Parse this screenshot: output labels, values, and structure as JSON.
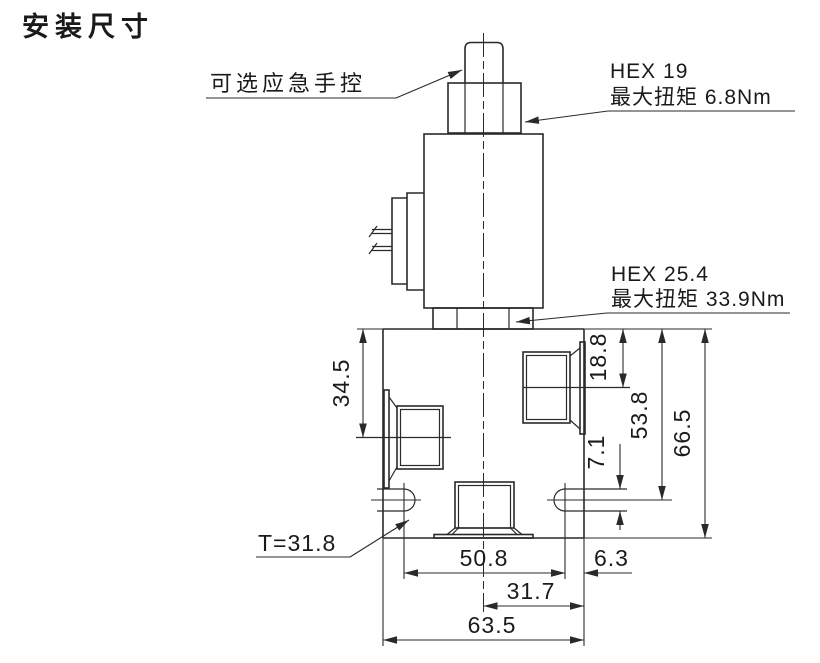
{
  "title": "安装尺寸",
  "labels": {
    "manual_override": "可选应急手控",
    "hex_top": {
      "line1": "HEX 19",
      "line2": "最大扭矩 6.8Nm"
    },
    "hex_cartridge": {
      "line1": "HEX 25.4",
      "line2": "最大扭矩 33.9Nm"
    },
    "thread_depth": "T=31.8"
  },
  "dims": {
    "left_port_from_top": "34.5",
    "right_port_from_top": "18.8",
    "slot_center_from_top": "53.8",
    "body_height": "66.5",
    "slot_width": "7.1",
    "slot_spacing": "50.8",
    "slot_to_edge": "6.3",
    "center_to_edge": "31.7",
    "body_width": "63.5"
  },
  "colors": {
    "line": "#2a2a2a",
    "text": "#1a1a1a",
    "background": "#ffffff"
  }
}
